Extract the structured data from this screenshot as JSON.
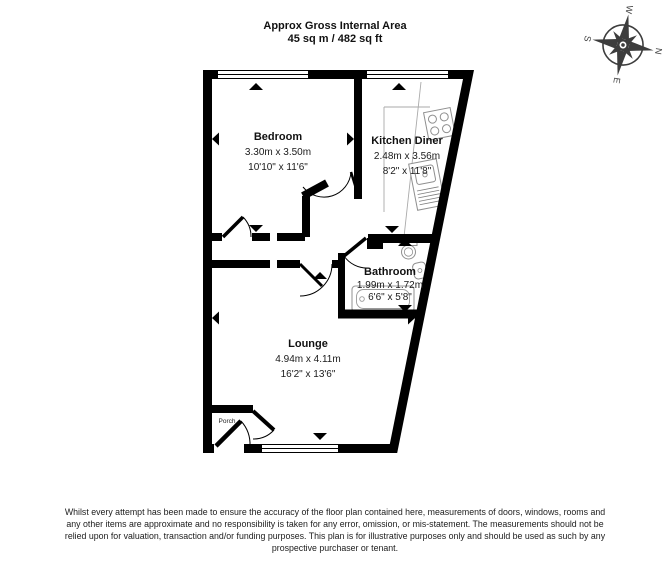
{
  "header": {
    "title_line1": "Approx Gross Internal Area",
    "title_line2": "45 sq m / 482 sq ft"
  },
  "compass": {
    "n": "N",
    "e": "E",
    "s": "S",
    "w": "W"
  },
  "rooms": {
    "bedroom": {
      "name": "Bedroom",
      "metric": "3.30m x 3.50m",
      "imperial": "10'10\" x 11'6\""
    },
    "kitchen": {
      "name": "Kitchen Diner",
      "metric": "2.48m x 3.56m",
      "imperial": "8'2\" x 11'8\""
    },
    "bathroom": {
      "name": "Bathroom",
      "metric": "1.99m x 1.72m",
      "imperial": "6'6\" x 5'8\""
    },
    "lounge": {
      "name": "Lounge",
      "metric": "4.94m x 4.11m",
      "imperial": "16'2\" x 13'6\""
    },
    "porch": {
      "name": "Porch"
    }
  },
  "footer": {
    "line1": "Whilst every attempt has been made to ensure the accuracy of the floor plan contained here, measurements of doors, windows, rooms and",
    "line2": "any other items are approximate and no responsibility is taken for any error, omission, or mis-statement. The measurements should not be",
    "line3": "relied upon for valuation, transaction and/or funding purposes. This plan is for illustrative purposes only and should be used as such by any",
    "line4": "prospective purchaser or tenant."
  },
  "colors": {
    "wall": "#000000",
    "fixture_outline": "#969696",
    "compass": "#3d3d3d",
    "background": "#ffffff"
  }
}
